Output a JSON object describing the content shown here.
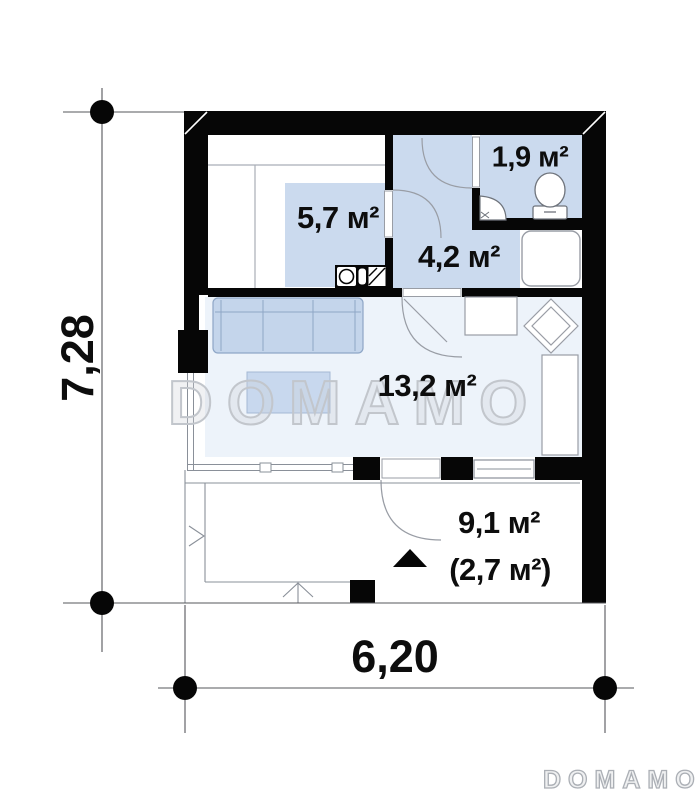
{
  "plan_title": "floor-plan",
  "rooms": {
    "wardrobe": {
      "label": "5,7 м²"
    },
    "bathroom": {
      "label": "1,9 м²"
    },
    "hallway": {
      "label": "4,2 м²"
    },
    "living": {
      "label": "13,2 м²"
    },
    "terrace": {
      "label": "9,1 м²",
      "label_covered": "(2,7 м²)"
    }
  },
  "dimensions": {
    "height": "7,28",
    "width": "6,20"
  },
  "watermark": {
    "center_text": "DOMAMO",
    "footer_text": "DOMAMO"
  },
  "symbols": [
    "toilet-icon",
    "corner-sink-icon",
    "shower-tray-icon",
    "kitchen-hob-icon",
    "sofa-icon",
    "coffee-table-icon",
    "corner-cabinet-icon",
    "kitchen-counter-icon",
    "entrance-arrow-icon",
    "door-swing-icon",
    "dimension-dot-icon"
  ],
  "colors": {
    "wall": "#060606",
    "room_fill": "#cbdaee",
    "living_fill": "#edf3fa",
    "furniture_fill": "#c4d5eb",
    "thin_line": "#8a9099",
    "dimension_line": "#555555",
    "watermark": "#c2c6cc",
    "label_text": "#0d0d0d"
  }
}
